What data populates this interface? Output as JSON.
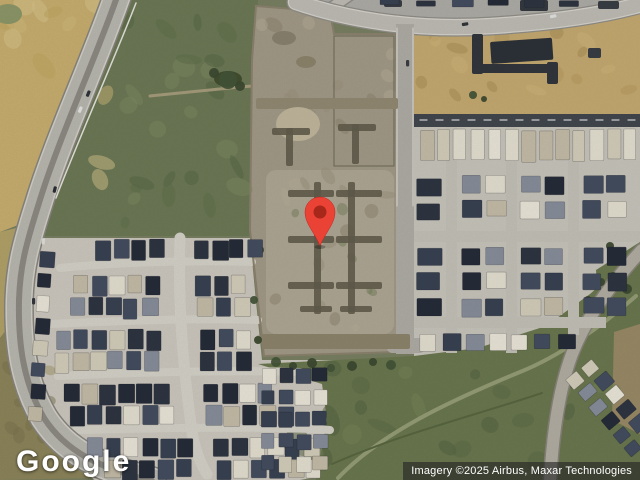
{
  "map": {
    "logo_text": "Google",
    "attribution_text": "Imagery ©2025 Airbus, Maxar Technologies",
    "marker": {
      "x": 320,
      "y": 246,
      "r": 15,
      "color": "#EA4335",
      "dot": "#A8271B"
    }
  },
  "palette": {
    "base_scrub": "#7b8263",
    "farmland": "#ccb272",
    "construction_pad": "#a69d8a",
    "trench": "#645e4e",
    "highway": "#bdbbb3",
    "dark_street": "#44484f",
    "field_green": "#6d7a50",
    "roof_dark_navy": "#2f3744",
    "roof_light": "#e8e3d4"
  },
  "scene": {
    "regions": [
      {
        "rect": [
          0,
          0,
          640,
          480,
          0
        ],
        "fill": "#7b8263"
      },
      {
        "pts": "0,0 118,0 26,222 0,232",
        "fill": "#ccb272"
      },
      {
        "pts": "0,232 24,226 14,320 0,338",
        "fill": "#b5a56a"
      },
      {
        "pts": "0,338 14,320 28,400 52,448 96,478 0,480",
        "fill": "#8f875c"
      },
      {
        "pts": "118,0 258,0 254,70 250,236 40,236 27,212",
        "fill": "#6e7b57"
      },
      {
        "pts": "256,6 330,12 334,34 396,34 398,352 264,356 250,230 252,60",
        "fill": "#a69d8a"
      },
      {
        "rect": [
          266,
          170,
          128,
          164,
          10
        ],
        "fill": "#b2aa97"
      },
      {
        "pts": "414,30 522,28 640,13 640,114 414,114",
        "fill": "#c8ac72"
      },
      {
        "pts": "414,114 640,114 640,246 600,270 596,334 544,372 414,358",
        "fill": "#cbc8bf"
      },
      {
        "pts": "596,270 640,242 640,336 600,336",
        "fill": "#6d7a50"
      },
      {
        "pts": "40,238 250,238 256,302 262,360 336,360 344,472 300,480 94,480 48,428 26,330 24,262",
        "fill": "#d0ccc2"
      },
      {
        "pts": "258,364 414,356 478,348 546,326 590,294 640,250 640,480 316,480 327,420 322,384",
        "fill": "#6d7a50"
      },
      {
        "pts": "614,332 640,324 640,434 612,420",
        "fill": "#9c8c68"
      },
      {
        "pts": "298,0 640,0 640,10 520,20 398,22 306,4",
        "fill": "#b2b0aa"
      }
    ],
    "textures": [
      {
        "r": [
          120,
          10,
          130,
          215
        ],
        "n": 26,
        "c": [
          "#5d6b49",
          "#7f8a63",
          "#64734e"
        ],
        "s": [
          4,
          14
        ],
        "o": 0.55
      },
      {
        "r": [
          2,
          2,
          105,
          200
        ],
        "n": 14,
        "c": [
          "#dcc98f",
          "#c2a860",
          "#d6bd7c"
        ],
        "s": [
          5,
          16
        ],
        "o": 0.5
      },
      {
        "r": [
          258,
          22,
          134,
          320
        ],
        "n": 30,
        "c": [
          "#9b937e",
          "#b7af9a",
          "#8e8670"
        ],
        "s": [
          3,
          10
        ],
        "o": 0.5
      },
      {
        "r": [
          282,
          182,
          104,
          136
        ],
        "n": 8,
        "c": [
          "#75815c"
        ],
        "s": [
          3,
          7
        ],
        "o": 0.5
      },
      {
        "r": [
          420,
          32,
          212,
          76
        ],
        "n": 16,
        "c": [
          "#b99c5f",
          "#d4b87c",
          "#a98f55"
        ],
        "s": [
          4,
          12
        ],
        "o": 0.5
      },
      {
        "r": [
          272,
          368,
          350,
          100
        ],
        "n": 24,
        "c": [
          "#5e6c47",
          "#7a8759",
          "#556343"
        ],
        "s": [
          5,
          16
        ],
        "o": 0.5
      },
      {
        "r": [
          4,
          344,
          52,
          124
        ],
        "n": 10,
        "c": [
          "#7e7550",
          "#a29868"
        ],
        "s": [
          4,
          10
        ],
        "o": 0.5
      }
    ],
    "paths_under": [
      {
        "d": "M150,96 C192,92 226,88 252,86",
        "w": 3,
        "c": "#a89f7e"
      },
      {
        "d": "M338,478 C382,432 452,400 520,372 C560,356 602,326 636,296",
        "w": 4,
        "c": "#98a078"
      },
      {
        "d": "M332,464 C400,434 470,417 542,393",
        "w": 2,
        "c": "#5a6841"
      },
      {
        "d": "M180,238 C178,300 182,360 192,432 C196,454 201,464 207,474",
        "w": 11,
        "c": "#d9d6cc"
      },
      {
        "d": "M60,268 C120,262 200,260 252,262",
        "w": 8,
        "c": "#d9d6cc"
      },
      {
        "d": "M52,324 C130,320 220,318 258,320",
        "w": 8,
        "c": "#d9d6cc"
      },
      {
        "d": "M58,376 C140,372 240,370 300,372",
        "w": 8,
        "c": "#d9d6cc"
      },
      {
        "d": "M76,430 C160,428 260,426 330,430",
        "w": 8,
        "c": "#d9d6cc"
      },
      {
        "d": "M256,6 L330,12 L334,34 L396,34 L398,352 L264,356 L250,230 L252,60 Z",
        "w": 2,
        "c": "#8e8570"
      },
      {
        "d": "M334,36 L394,36 L394,166 L334,166 Z",
        "w": 1,
        "c": "#6f6a58"
      }
    ],
    "roads": [
      {
        "d": "M118,-6 C96,58 58,140 39,203 C25,247 20,268 19,300 C18,346 24,384 44,418 C66,452 100,468 152,481",
        "layers": [
          [
            30,
            "#8a887f"
          ],
          [
            27,
            "#d6d4cc"
          ],
          [
            24,
            "#bdbbb3"
          ],
          [
            6,
            "#8f8d85"
          ]
        ]
      },
      {
        "d": "M324,13 L354,-8",
        "layers": [
          [
            13,
            "#93918a"
          ],
          [
            10,
            "#c2c0b8"
          ]
        ]
      },
      {
        "d": "M296,2 C360,24 430,30 492,26 C556,22 606,14 642,4",
        "layers": [
          [
            19,
            "#93918a"
          ],
          [
            16.5,
            "#dad8d0"
          ],
          [
            14,
            "#c2c0b8"
          ]
        ]
      },
      {
        "d": "M642,250 C612,282 586,318 572,354 C560,386 553,428 550,482",
        "layers": [
          [
            15,
            "#8b877d"
          ],
          [
            12,
            "#b5b1a6"
          ]
        ]
      }
    ],
    "streets": [
      {
        "x": 396,
        "y": 24,
        "w": 18,
        "h": 330,
        "c": "#b2b0a8"
      },
      {
        "x": 387,
        "y": 338,
        "w": 38,
        "h": 15,
        "c": "#b2b0a8",
        "rx": 5
      },
      {
        "x": 414,
        "y": 114,
        "w": 226,
        "h": 13,
        "c": "#44484f"
      },
      {
        "x": 446,
        "y": 127,
        "w": 11,
        "h": 226,
        "c": "#c7c4bb"
      },
      {
        "x": 506,
        "y": 127,
        "w": 11,
        "h": 226,
        "c": "#c7c4bb"
      },
      {
        "x": 568,
        "y": 127,
        "w": 11,
        "h": 208,
        "c": "#c7c4bb"
      },
      {
        "x": 414,
        "y": 231,
        "w": 226,
        "h": 11,
        "c": "#c7c4bb"
      },
      {
        "x": 414,
        "y": 317,
        "w": 192,
        "h": 11,
        "c": "#c7c4bb"
      }
    ],
    "paths_over": [
      {
        "d": "M136,3 C114,60 79,138 56,198",
        "w": 1.5,
        "c": "#e9e7e0"
      },
      {
        "d": "M397,28 L397,206",
        "w": 1,
        "c": "#e4e2da"
      },
      {
        "d": "M413,28 L413,206",
        "w": 1,
        "c": "#e4e2da"
      },
      {
        "d": "M420,120 L638,120",
        "w": 1.2,
        "c": "#d8dadc",
        "dash": "7,9"
      }
    ],
    "misc_rects": [
      [
        472,
        34,
        11,
        40,
        "#33383e",
        0
      ],
      [
        472,
        64,
        86,
        9,
        "#33383e",
        0
      ],
      [
        547,
        62,
        11,
        22,
        "#33383e",
        0
      ],
      [
        490,
        42,
        62,
        22,
        "#2e333a",
        -4
      ],
      [
        588,
        48,
        13,
        10,
        "#3a3f46",
        0
      ],
      [
        384,
        0,
        18,
        7,
        "#3a3f46",
        0
      ],
      [
        520,
        0,
        28,
        11,
        "#353a41",
        0
      ],
      [
        598,
        1,
        21,
        8,
        "#3a3f46",
        0
      ],
      [
        262,
        334,
        148,
        15,
        "#8f866d",
        0
      ],
      [
        256,
        98,
        142,
        11,
        "#958c74",
        0
      ]
    ],
    "misc_ellipses": [
      [
        298,
        124,
        22,
        17,
        "#c4ba9f"
      ],
      [
        8,
        14,
        14,
        10,
        "#8f9a6a"
      ],
      [
        228,
        79,
        14,
        8,
        "#43502f"
      ],
      [
        284,
        38,
        12,
        7,
        "#8d8471"
      ],
      [
        306,
        62,
        10,
        6,
        "#90876f"
      ]
    ],
    "trenches": [
      [
        272,
        128,
        38,
        7
      ],
      [
        286,
        128,
        7,
        38
      ],
      [
        338,
        124,
        38,
        7
      ],
      [
        352,
        124,
        7,
        40
      ],
      [
        314,
        182,
        7,
        132
      ],
      [
        348,
        182,
        7,
        132
      ],
      [
        288,
        190,
        46,
        7
      ],
      [
        288,
        236,
        46,
        7
      ],
      [
        288,
        282,
        46,
        7
      ],
      [
        336,
        190,
        46,
        7
      ],
      [
        336,
        236,
        46,
        7
      ],
      [
        336,
        282,
        46,
        7
      ],
      [
        300,
        306,
        32,
        6
      ],
      [
        340,
        306,
        32,
        6
      ]
    ],
    "trees": [
      [
        276,
        362,
        5
      ],
      [
        293,
        366,
        4
      ],
      [
        312,
        363,
        5
      ],
      [
        331,
        368,
        4
      ],
      [
        352,
        366,
        5
      ],
      [
        373,
        362,
        4
      ],
      [
        391,
        365,
        5
      ],
      [
        300,
        380,
        3
      ],
      [
        601,
        282,
        4
      ],
      [
        613,
        276,
        4
      ],
      [
        627,
        289,
        5
      ],
      [
        588,
        300,
        4
      ],
      [
        228,
        80,
        9
      ],
      [
        214,
        73,
        5
      ],
      [
        240,
        86,
        5
      ],
      [
        473,
        95,
        4
      ],
      [
        484,
        99,
        3
      ],
      [
        260,
        250,
        4
      ],
      [
        254,
        300,
        4
      ],
      [
        258,
        340,
        4
      ],
      [
        610,
        246,
        4
      ]
    ],
    "roofs": {
      "dark": [
        "#2f3744",
        "#3a4354",
        "#262d3a",
        "#454f62"
      ],
      "light": [
        "#e8e3d4",
        "#d8d1be",
        "#efeadd",
        "#c8c0aa"
      ],
      "mid": "#8a919e"
    },
    "house_blocks": [
      {
        "x": 420,
        "y": 130,
        "cols": 13,
        "rows": 1,
        "w": 13,
        "h": 30,
        "gx": 4,
        "gy": 0,
        "mix": "light"
      },
      {
        "x": 417,
        "y": 178,
        "cols": 1,
        "rows": 2,
        "w": 24,
        "h": 17,
        "gx": 0,
        "gy": 8,
        "mix": "dark"
      },
      {
        "x": 417,
        "y": 248,
        "cols": 1,
        "rows": 3,
        "w": 24,
        "h": 17,
        "gx": 0,
        "gy": 8,
        "mix": "dark"
      },
      {
        "x": 462,
        "y": 176,
        "cols": 2,
        "rows": 2,
        "w": 19,
        "h": 17,
        "gx": 5,
        "gy": 8,
        "mix": "mixed"
      },
      {
        "x": 462,
        "y": 248,
        "cols": 2,
        "rows": 3,
        "w": 19,
        "h": 17,
        "gx": 5,
        "gy": 8,
        "mix": "mixed"
      },
      {
        "x": 521,
        "y": 176,
        "cols": 2,
        "rows": 2,
        "w": 19,
        "h": 17,
        "gx": 5,
        "gy": 8,
        "mix": "mixed"
      },
      {
        "x": 521,
        "y": 248,
        "cols": 2,
        "rows": 3,
        "w": 19,
        "h": 17,
        "gx": 5,
        "gy": 8,
        "mix": "mixed"
      },
      {
        "x": 583,
        "y": 176,
        "cols": 2,
        "rows": 2,
        "w": 19,
        "h": 17,
        "gx": 5,
        "gy": 8,
        "mix": "mixed"
      },
      {
        "x": 583,
        "y": 248,
        "cols": 2,
        "rows": 3,
        "w": 19,
        "h": 17,
        "gx": 5,
        "gy": 8,
        "mix": "dark"
      },
      {
        "x": 420,
        "y": 334,
        "cols": 7,
        "rows": 1,
        "w": 17,
        "h": 16,
        "gx": 6,
        "gy": 0,
        "mix": "mixed"
      },
      {
        "x": 96,
        "y": 240,
        "cols": 4,
        "mix": "dark"
      },
      {
        "x": 194,
        "y": 240,
        "cols": 4,
        "mix": "dark"
      },
      {
        "x": 74,
        "y": 276,
        "cols": 5,
        "mix": "mixed"
      },
      {
        "x": 196,
        "y": 276,
        "cols": 3,
        "mix": "mixed"
      },
      {
        "x": 70,
        "y": 298,
        "cols": 5,
        "mix": "mixed"
      },
      {
        "x": 198,
        "y": 298,
        "cols": 3,
        "mix": "mixed"
      },
      {
        "x": 56,
        "y": 330,
        "cols": 6,
        "mix": "mixed"
      },
      {
        "x": 200,
        "y": 330,
        "cols": 3,
        "mix": "mixed"
      },
      {
        "x": 54,
        "y": 352,
        "cols": 6,
        "mix": "mixed"
      },
      {
        "x": 200,
        "y": 352,
        "cols": 3,
        "mix": "mixed"
      },
      {
        "x": 64,
        "y": 384,
        "cols": 6,
        "mix": "mixed"
      },
      {
        "x": 204,
        "y": 384,
        "cols": 4,
        "mix": "mixed"
      },
      {
        "x": 70,
        "y": 406,
        "cols": 6,
        "mix": "mixed"
      },
      {
        "x": 206,
        "y": 406,
        "cols": 5,
        "mix": "mixed"
      },
      {
        "x": 88,
        "y": 438,
        "cols": 6,
        "mix": "mixed"
      },
      {
        "x": 214,
        "y": 438,
        "cols": 6,
        "mix": "mixed"
      },
      {
        "x": 104,
        "y": 460,
        "cols": 5,
        "mix": "mixed"
      },
      {
        "x": 216,
        "y": 460,
        "cols": 6,
        "mix": "mixed"
      },
      {
        "x": 40,
        "y": 252,
        "cols": 1,
        "rows": 8,
        "w": 14,
        "h": 15,
        "gx": 0,
        "gy": 7,
        "mix": "mixed",
        "rot": 4
      },
      {
        "x": 262,
        "y": 368,
        "cols": 4,
        "rows": 5,
        "w": 14,
        "h": 15,
        "gx": 3,
        "gy": 7,
        "mix": "mixed"
      },
      {
        "x": 566,
        "y": 380,
        "cols": 2,
        "rows": 6,
        "w": 15,
        "h": 13,
        "gx": 5,
        "gy": 5,
        "mix": "mixed",
        "rot": -40
      },
      {
        "x": 380,
        "y": 0,
        "cols": 6,
        "rows": 1,
        "w": 20,
        "h": 7,
        "gx": 16,
        "gy": 0,
        "mix": "dark"
      }
    ],
    "cars": [
      [
        88,
        90,
        "#2f333c",
        22
      ],
      [
        80,
        106,
        "#e8e8e6",
        22
      ],
      [
        54,
        186,
        "#2c3036",
        14
      ],
      [
        42,
        238,
        "#e2e2df",
        4
      ],
      [
        32,
        298,
        "#34383f",
        0
      ],
      [
        468,
        22,
        "#33373d",
        80
      ],
      [
        556,
        14,
        "#e6e6e4",
        78
      ],
      [
        406,
        60,
        "#3c4046",
        0
      ]
    ]
  }
}
